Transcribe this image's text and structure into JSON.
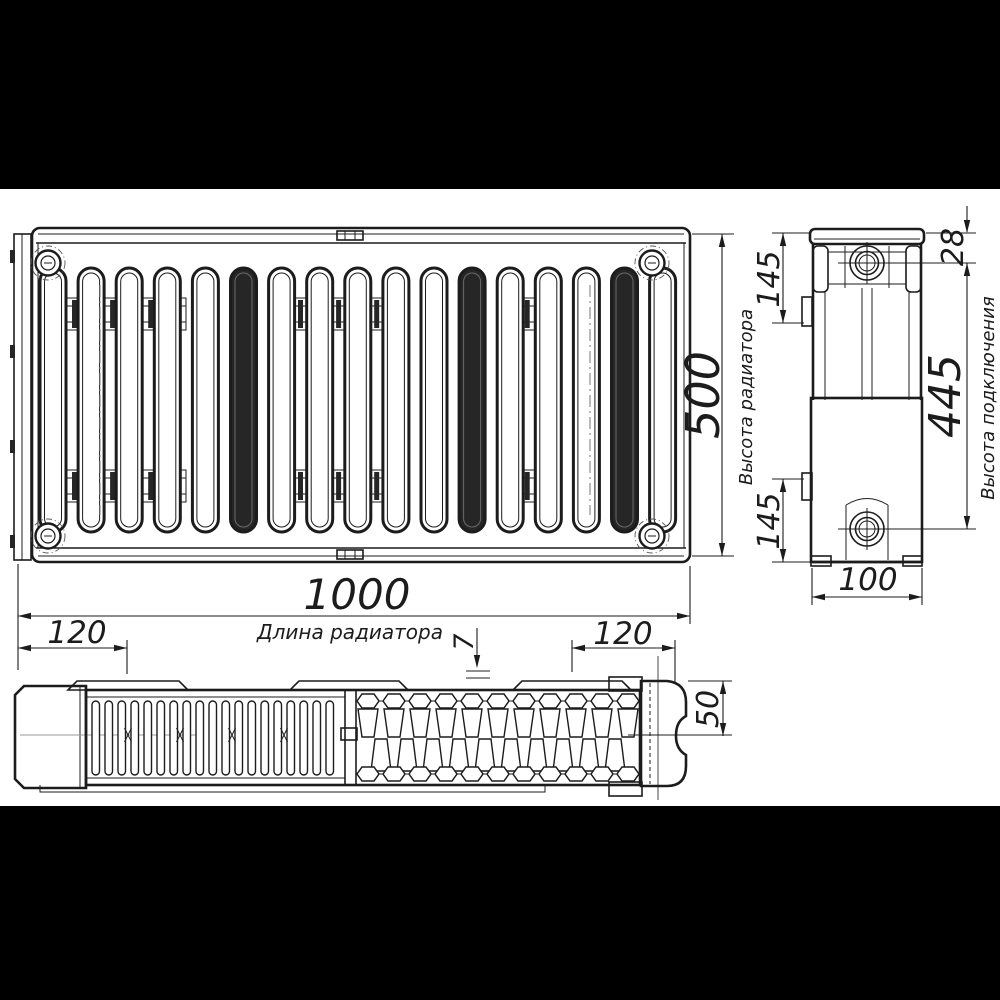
{
  "drawing": {
    "kind": "panel-radiator-dimension-drawing",
    "colors": {
      "background": "#ffffff",
      "letterbox": "#000000",
      "line": "#1c1c1c",
      "dark_fill": "#262626",
      "centerline": "#999999"
    },
    "dims": {
      "length": {
        "value": "1000",
        "label": "Длина радиатора"
      },
      "height": {
        "value": "500",
        "label": "Высота радиатора"
      },
      "connection": {
        "value": "445",
        "label": "Высота подключения"
      },
      "depth": {
        "value": "100"
      },
      "top_offset": {
        "value": "28"
      },
      "bracket_top": {
        "value": "145"
      },
      "bracket_bottom": {
        "value": "145"
      },
      "bracket_left": {
        "value": "120"
      },
      "bracket_right": {
        "value": "120"
      },
      "panel_gap": {
        "value": "7"
      },
      "half_depth": {
        "value": "50"
      }
    }
  }
}
